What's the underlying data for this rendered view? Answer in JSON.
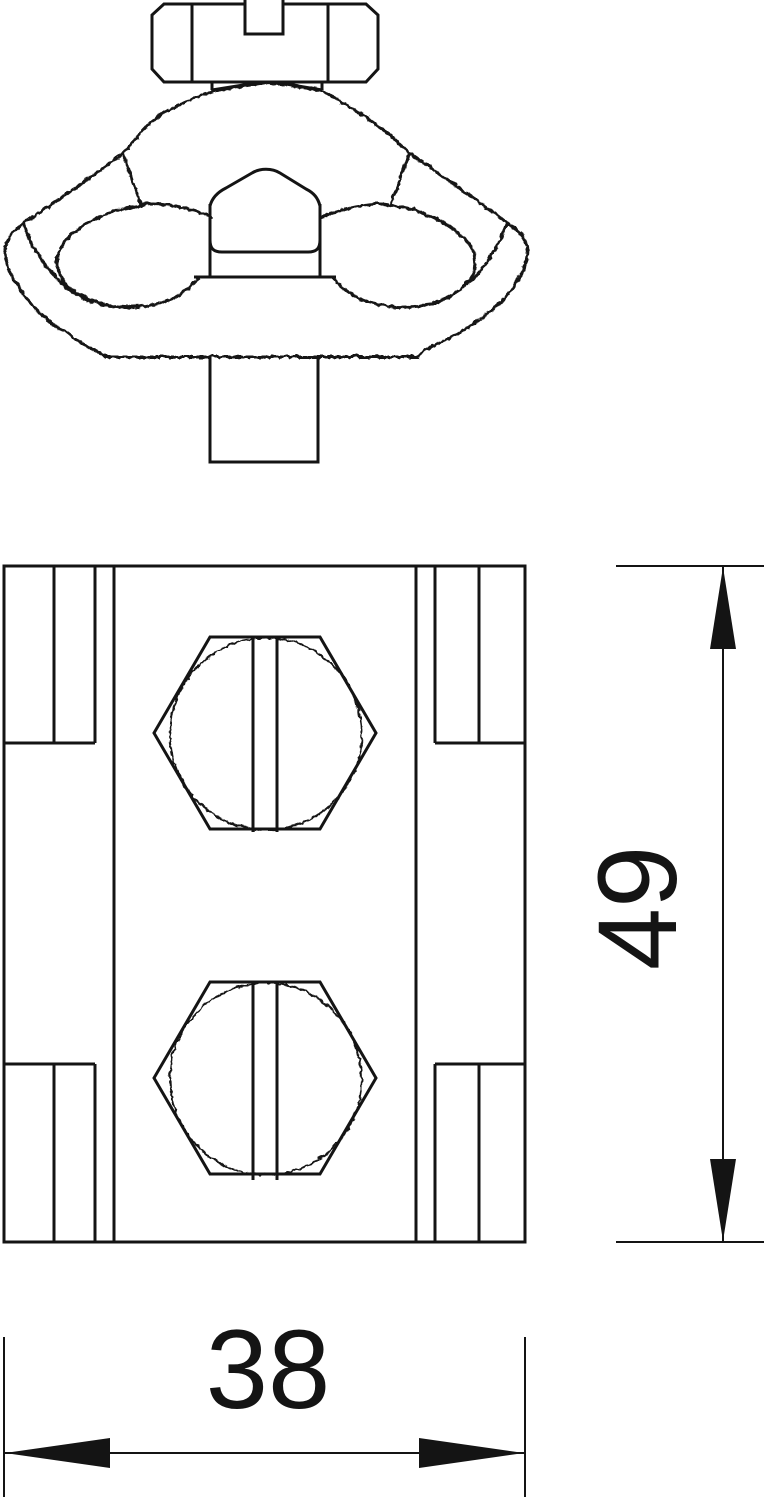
{
  "drawing": {
    "background": "#ffffff",
    "line_color": "#141414",
    "dimensions": [
      {
        "id": "height",
        "value": "49",
        "orientation": "vertical"
      },
      {
        "id": "width",
        "value": "38",
        "orientation": "horizontal"
      }
    ]
  }
}
